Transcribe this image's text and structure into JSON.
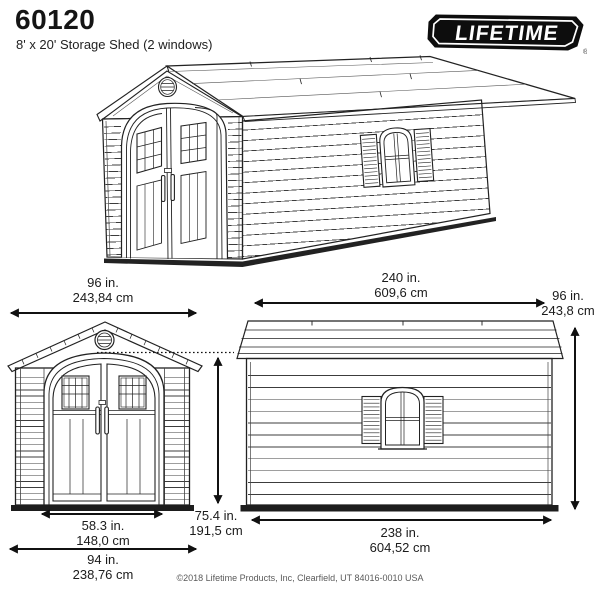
{
  "header": {
    "model": "60120",
    "subtitle": "8' x 20' Storage Shed (2 windows)"
  },
  "logo": {
    "brand": "LIFETIME",
    "registered": "®"
  },
  "dimensions": {
    "front_width": {
      "inches": "96 in.",
      "cm": "243,84 cm"
    },
    "side_length": {
      "inches": "240 in.",
      "cm": "609,6 cm"
    },
    "side_height": {
      "inches": "96 in.",
      "cm": "243,8 cm"
    },
    "door_width": {
      "inches": "58.3 in.",
      "cm": "148,0 cm"
    },
    "front_base_width": {
      "inches": "94 in.",
      "cm": "238,76 cm"
    },
    "door_height": {
      "inches": "75.4 in.",
      "cm": "191,5 cm"
    },
    "side_base_length": {
      "inches": "238 in.",
      "cm": "604,52 cm"
    }
  },
  "footer": {
    "copyright": "©2018 Lifetime Products, Inc, Clearfield, UT 84016-0010 USA"
  },
  "colors": {
    "line": "#222222",
    "label_text": "#1b1b1b",
    "logo_background": "#0d0d0d",
    "logo_text": "#ffffff",
    "base_skid": "#1d1d1d",
    "background": "#ffffff",
    "copyright_text": "#5a5a5a"
  }
}
